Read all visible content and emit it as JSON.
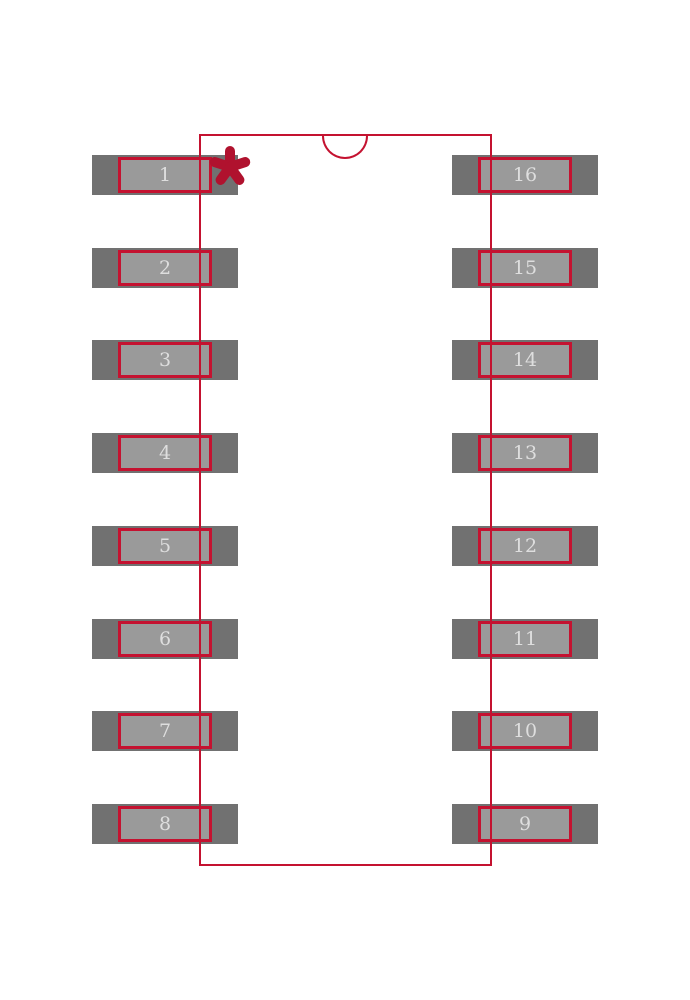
{
  "diagram": {
    "kind": "ic-footprint-land-pattern",
    "pin_count": 16,
    "pads": {
      "left": [
        "1",
        "2",
        "3",
        "4",
        "5",
        "6",
        "7",
        "8"
      ],
      "right": [
        "16",
        "15",
        "14",
        "13",
        "12",
        "11",
        "10",
        "9"
      ]
    },
    "pin1_marker": {
      "glyph": "asterisk",
      "color": "#b0122e"
    },
    "body": {
      "notch": "top-center-semicircle"
    },
    "colors": {
      "outline_red": "#c41230",
      "marker_red": "#b0122e",
      "pad_copper": "#717171",
      "pad_land": "#9a9a9a",
      "pad_number_text": "#dedede",
      "background": "#ffffff"
    }
  }
}
